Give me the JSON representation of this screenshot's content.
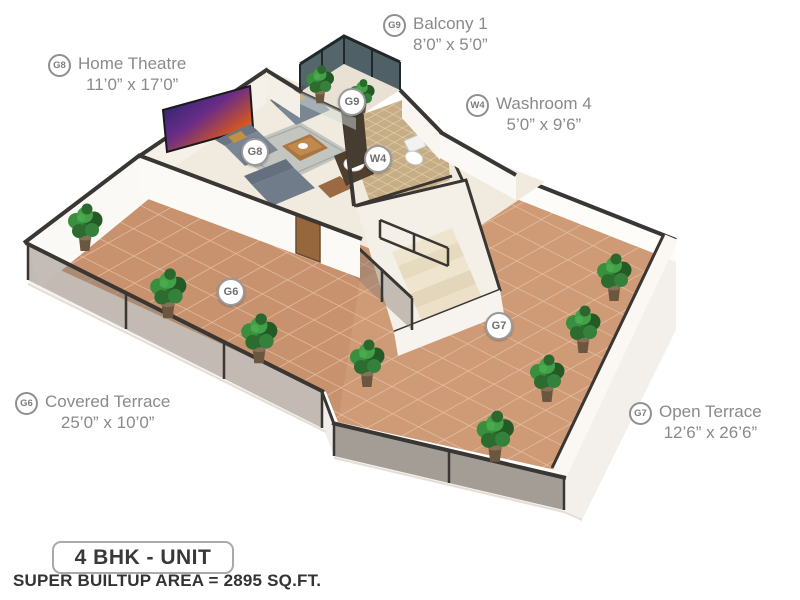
{
  "labels": {
    "home_theatre": {
      "id": "G8",
      "name": "Home Theatre",
      "dims": "11’0” x 17’0”"
    },
    "balcony": {
      "id": "G9",
      "name": "Balcony 1",
      "dims": "8’0” x 5’0”"
    },
    "washroom": {
      "id": "W4",
      "name": "Washroom 4",
      "dims": "5’0” x 9’6”"
    },
    "covered_terrace": {
      "id": "G6",
      "name": "Covered Terrace",
      "dims": "25’0” x 10’0”"
    },
    "open_terrace": {
      "id": "G7",
      "name": "Open Terrace",
      "dims": "12’6” x 26’6”"
    }
  },
  "footer": {
    "unit_badge": "4 BHK - UNIT",
    "builtup_area": "SUPER BUILTUP AREA = 2895 SQ.FT."
  },
  "colors": {
    "label_text": "#8a8a8a",
    "footer_text": "#333333",
    "tile_floor": "#c9926f",
    "tile_grout": "#e8c6ab",
    "wall_top": "#3a3633",
    "wall_face": "#fcfaf7",
    "railing_glass": "#92857a",
    "balcony_glass": "#47595e",
    "plant_green": "#2d6c2f",
    "sofa_gray": "#7b8694",
    "wood_brown": "#9a6a42"
  }
}
